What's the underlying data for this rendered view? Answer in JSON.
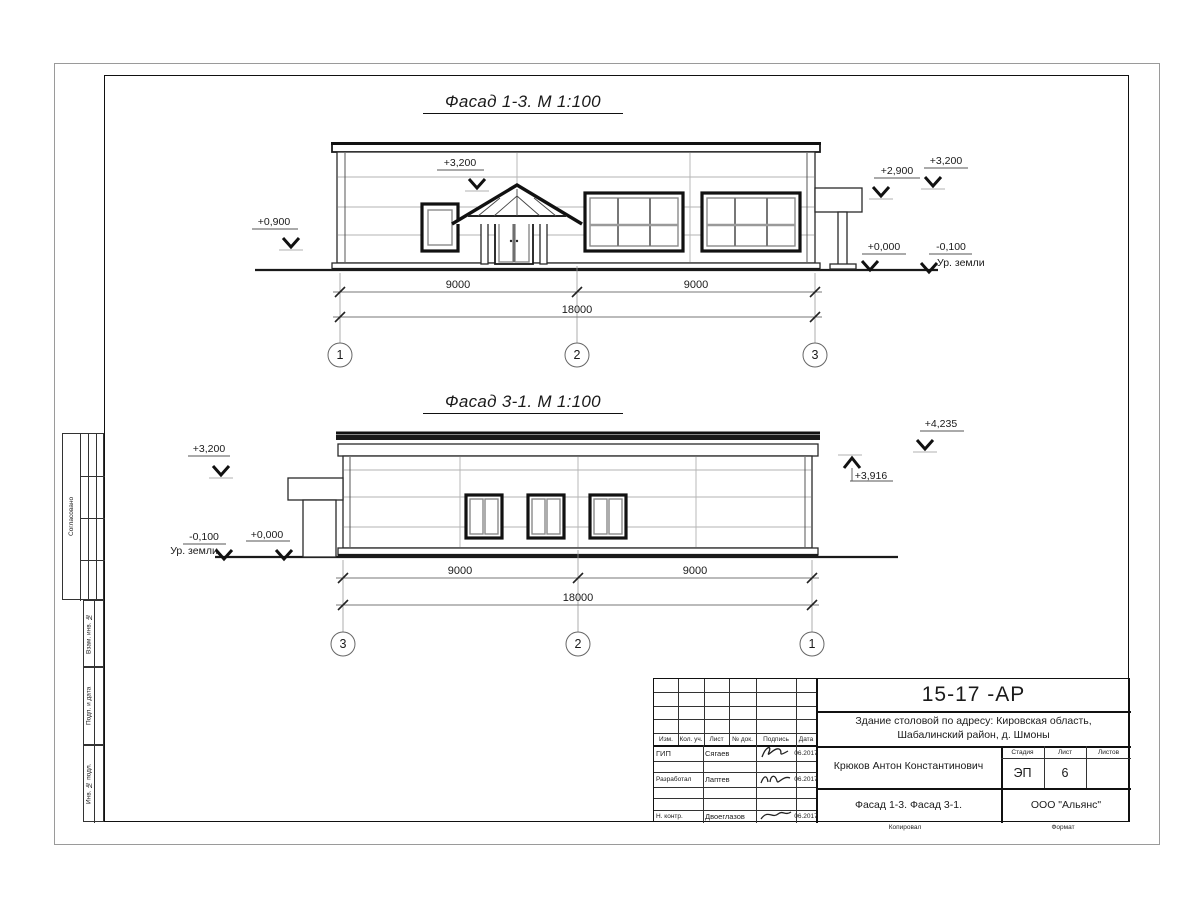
{
  "facade1": {
    "title": "Фасад 1-3.  М 1:100",
    "dims": {
      "left": "9000",
      "right": "9000",
      "total": "18000"
    },
    "axes": {
      "left": "1",
      "mid": "2",
      "right": "3"
    },
    "marks": {
      "left": "+0,900",
      "roof": "+3,200",
      "canopy": "+2,900",
      "parapet": "+3,200",
      "floor": "+0,000",
      "ground": "-0,100",
      "ground_label": "Ур. земли"
    }
  },
  "facade2": {
    "title": "Фасад 3-1.  М 1:100",
    "dims": {
      "left": "9000",
      "right": "9000",
      "total": "18000"
    },
    "axes": {
      "left": "3",
      "mid": "2",
      "right": "1"
    },
    "marks": {
      "canopy": "+3,200",
      "ground": "-0,100",
      "ground_label": "Ур. земли",
      "floor": "+0,000",
      "parapet": "+3,916",
      "roof": "+4,235"
    }
  },
  "titleblock": {
    "doc_number": "15-17 -АР",
    "project_line1": "Здание столовой по адресу: Кировская область,",
    "project_line2": "Шабалинский район, д. Шмоны",
    "author": "Крюков Антон Константинович",
    "drawing_title": "Фасад 1-3. Фасад 3-1.",
    "company": "ООО \"Альянс\"",
    "stage_label": "Стадия",
    "sheet_label": "Лист",
    "sheets_label": "Листов",
    "stage": "ЭП",
    "sheet_no": "6",
    "sheets_total": "",
    "header": {
      "izm": "Изм.",
      "kol": "Кол. уч.",
      "list": "Лист",
      "doc": "№ док.",
      "sign": "Подпись",
      "date": "Дата"
    },
    "rows": [
      {
        "role": "ГИП",
        "name": "Сягаев",
        "date": "06.2017"
      },
      {
        "role": "Разработал",
        "name": "Лаптев",
        "date": "06.2017"
      },
      {
        "role": "Н. контр.",
        "name": "Двоеглазов",
        "date": "06.2017"
      }
    ],
    "footer": {
      "copied": "Копировал",
      "format": "Формат"
    }
  },
  "side_stamps": {
    "agreed": "Согласовано",
    "vzam": "Взам. инв. №",
    "podp": "Подп. и дата",
    "inv": "Инв. № подл."
  }
}
